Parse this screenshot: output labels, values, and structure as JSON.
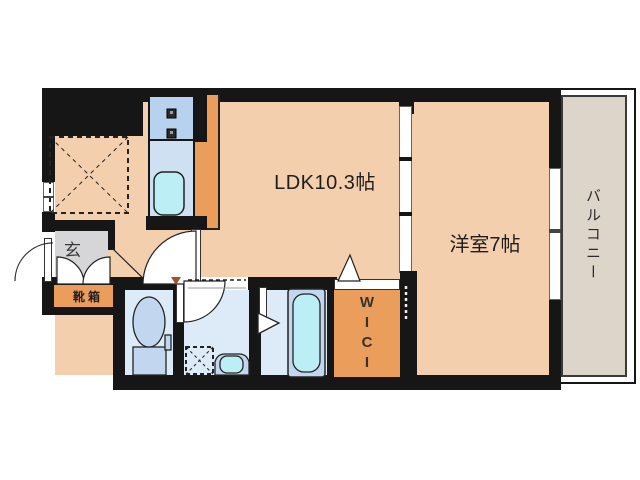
{
  "plan": {
    "type": "apartment-floor-plan",
    "rooms": {
      "ldk": {
        "label": "LDK10.3帖"
      },
      "western_room": {
        "label": "洋室7帖"
      },
      "balcony": {
        "label": "バルコニー"
      },
      "entrance": {
        "label": "玄"
      },
      "shoe_box": {
        "label": "靴箱"
      },
      "wic": {
        "label": "WIC",
        "chars": [
          "W",
          "I",
          "C",
          "I"
        ]
      },
      "toilet": {
        "label": ""
      },
      "washroom": {
        "label": ""
      },
      "bathroom": {
        "label": ""
      }
    },
    "colors": {
      "wall": "#161616",
      "floor": "#f3cfae",
      "accent_orange": "#eb9d5b",
      "entry_gray": "#d6d6d8",
      "balcony_beige": "#ddd4ca",
      "room_blue": "#dcebf7",
      "fixture_blue": "#c2d7ef",
      "water_cyan": "#bceef6",
      "kitchen_blue": "#b6d2ee",
      "sink_panel_blue": "#cfe0f2",
      "door_marker_brown": "#a0522d"
    }
  }
}
